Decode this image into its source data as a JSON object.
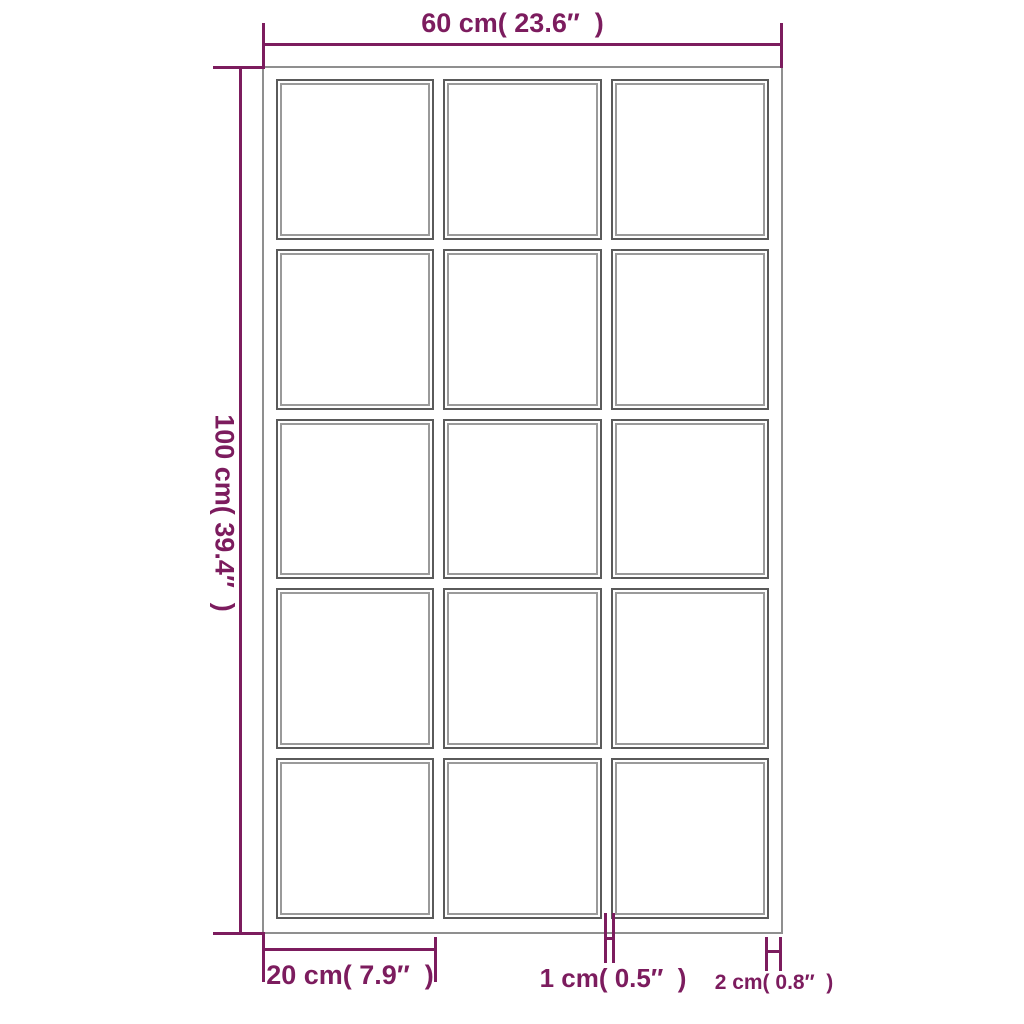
{
  "colors": {
    "dimension_accent": "#7c1c5e",
    "frame_outline": "#8f8f8f",
    "pane_outline_dark": "#5a5a5a",
    "pane_outline_light": "#9a9a9a",
    "background": "#ffffff"
  },
  "mirror": {
    "grid": {
      "rows": 5,
      "columns": 3,
      "pane_count": 15
    }
  },
  "dimensions": {
    "width": {
      "label": "60 cm( 23.6″  )"
    },
    "height": {
      "label": "100 cm( 39.4″  )"
    },
    "pane_width": {
      "label": "20 cm( 7.9″  )"
    },
    "mullion_width": {
      "label": "1 cm( 0.5″  )"
    },
    "frame_width": {
      "label": "2 cm( 0.8″  )"
    }
  }
}
